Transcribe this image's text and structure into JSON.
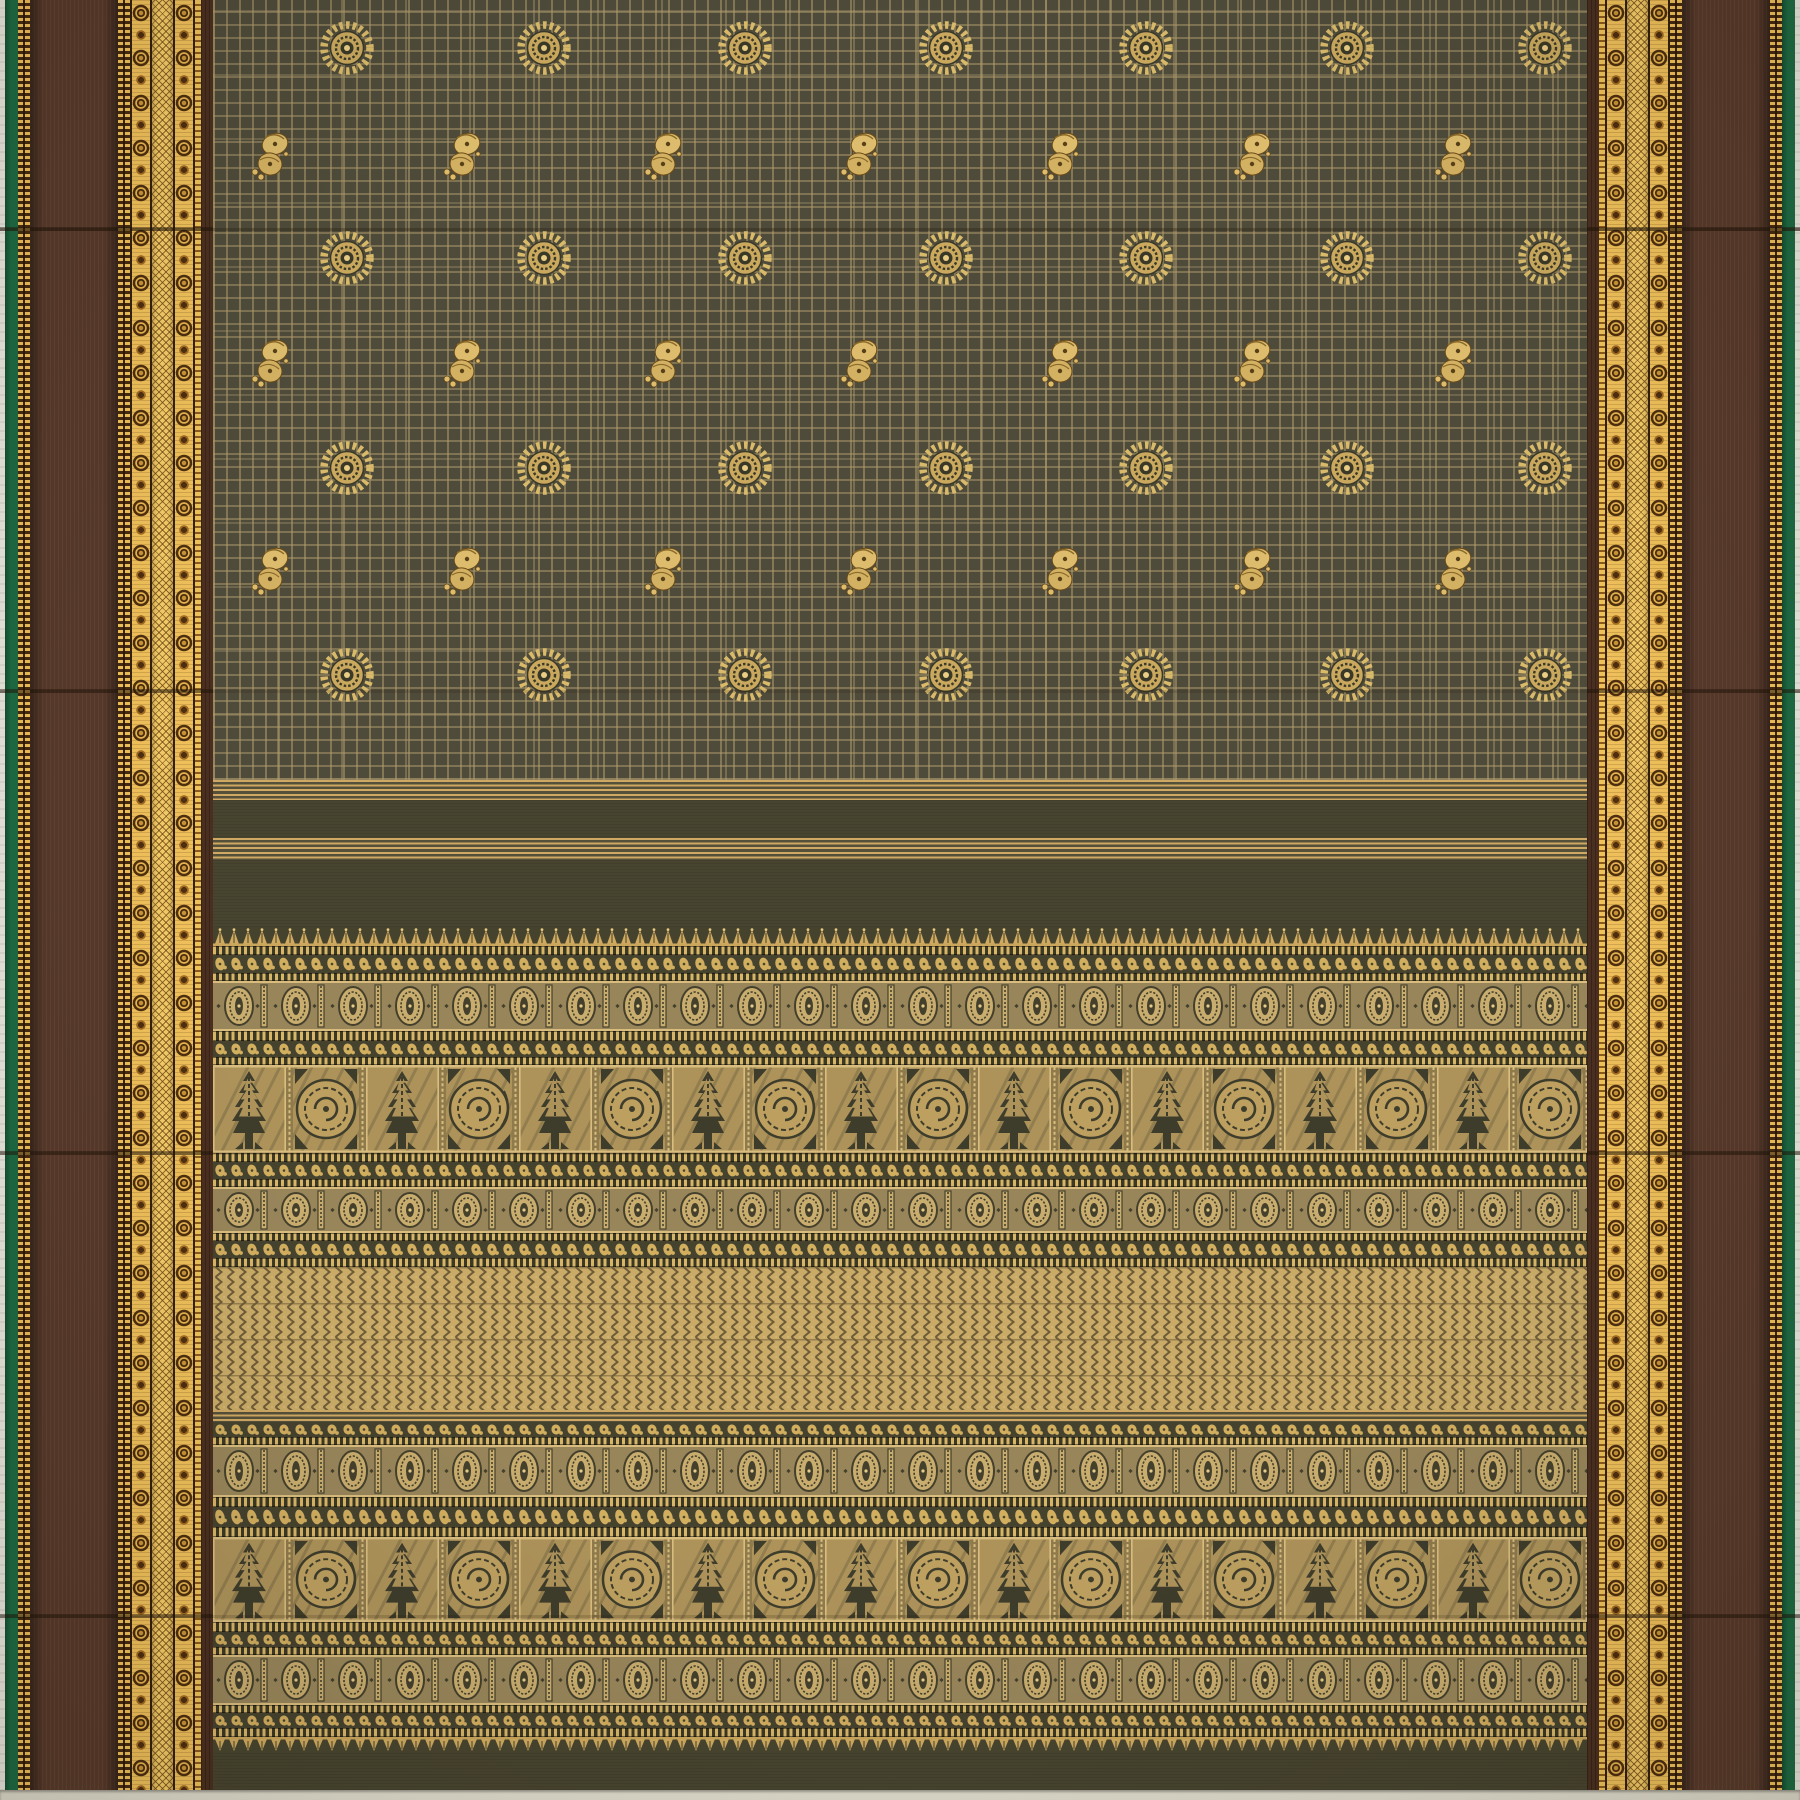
{
  "description": "Flat-lay photograph of a handloom saree: dark olive-grey body with fine gold checks and gold zari buttas (chakra discs and paisley mangoes), maroon-brown side borders with ornate gold zari bands on green selvedges, and a wide gold pallu of temple spires, medallion bands, tree-and-peacock motif rows and a gold herringbone field",
  "palette": {
    "selvage_white": "#eae7de",
    "selvage_bottom": "#dedacb",
    "green": "#1d6a43",
    "green_dark": "#124e31",
    "brown": "#57392a",
    "brown_inner": "#4a2f20",
    "gold_bright": "#efc05a",
    "gold_dark_motif": "#4d2e10",
    "mesh_gold": "#f4ca67",
    "body_olive": "#4e4b3a",
    "check_line": "#af9b6c",
    "butta_gold": "#d9ba6a",
    "butta_core_dark": "#3a3827",
    "plain_band": "#47442f",
    "stripe_gold": "#cfa963",
    "pallu_base_dark": "#45422e",
    "pallu_gold": "#d2ae5f",
    "medallion_bg": "#98855a",
    "medallion_gold": "#c9ad6e",
    "medallion_dark": "#44402c",
    "panel_gold": "#ad935a",
    "panel_dark": "#3e3c2b",
    "herringbone_gold": "#c9ab67",
    "herringbone_line": "#6e5b38",
    "crease": "rgba(32,20,9,0.45)"
  },
  "layout": {
    "width": 1800,
    "height": 1800,
    "border_width": 213,
    "body_left": 213,
    "body_width": 1374,
    "body_height": 780,
    "bottom_selvage_y": 1790
  },
  "left_border_strips": [
    {
      "type": "selvage",
      "w": 5
    },
    {
      "type": "green",
      "w": 13
    },
    {
      "type": "gold-dot",
      "w": 12
    },
    {
      "type": "brown",
      "w": 88
    },
    {
      "type": "gold-dot",
      "w": 12
    },
    {
      "type": "ring-band",
      "w": 22
    },
    {
      "type": "mesh",
      "w": 21
    },
    {
      "type": "ring-band",
      "w": 22
    },
    {
      "type": "gold-line",
      "w": 6
    },
    {
      "type": "brown-inner",
      "w": 12
    }
  ],
  "right_border_strips": [
    {
      "type": "brown-inner",
      "w": 12
    },
    {
      "type": "gold-line",
      "w": 6
    },
    {
      "type": "ring-band",
      "w": 22
    },
    {
      "type": "mesh",
      "w": 21
    },
    {
      "type": "ring-band",
      "w": 22
    },
    {
      "type": "gold-dot",
      "w": 12
    },
    {
      "type": "brown",
      "w": 88
    },
    {
      "type": "gold-dot",
      "w": 12
    },
    {
      "type": "green",
      "w": 13
    },
    {
      "type": "selvage",
      "w": 5
    }
  ],
  "body_motif_rows": [
    {
      "motif": "chakra",
      "y": 48,
      "x": [
        347,
        544,
        745,
        946,
        1146,
        1347,
        1545
      ]
    },
    {
      "motif": "paisley",
      "y": 155,
      "x": [
        271,
        463,
        664,
        860,
        1061,
        1253,
        1454
      ]
    },
    {
      "motif": "chakra",
      "y": 258,
      "x": [
        347,
        544,
        745,
        946,
        1146,
        1347,
        1545
      ]
    },
    {
      "motif": "paisley",
      "y": 362,
      "x": [
        271,
        463,
        664,
        860,
        1061,
        1253,
        1454
      ]
    },
    {
      "motif": "chakra",
      "y": 468,
      "x": [
        347,
        544,
        745,
        946,
        1146,
        1347,
        1545
      ]
    },
    {
      "motif": "paisley",
      "y": 570,
      "x": [
        271,
        463,
        664,
        860,
        1061,
        1253,
        1454
      ]
    },
    {
      "motif": "chakra",
      "y": 675,
      "x": [
        347,
        544,
        745,
        946,
        1146,
        1347,
        1545
      ]
    }
  ],
  "pallu_bands": [
    {
      "type": "stripe-gold",
      "y": 780,
      "h": 20
    },
    {
      "type": "plain",
      "y": 800,
      "h": 38
    },
    {
      "type": "stripe-gold",
      "y": 838,
      "h": 22
    },
    {
      "type": "plain",
      "y": 860,
      "h": 67
    },
    {
      "type": "spikes-up",
      "y": 927,
      "h": 19
    },
    {
      "type": "dot-line",
      "y": 946,
      "h": 9
    },
    {
      "type": "comma-row",
      "y": 955,
      "h": 18
    },
    {
      "type": "dot-line",
      "y": 973,
      "h": 8
    },
    {
      "type": "medallion-band",
      "y": 981,
      "h": 50
    },
    {
      "type": "dot-line",
      "y": 1031,
      "h": 10
    },
    {
      "type": "comma-row",
      "y": 1041,
      "h": 16
    },
    {
      "type": "dot-line",
      "y": 1057,
      "h": 8
    },
    {
      "type": "large-motif-row",
      "y": 1065,
      "h": 88
    },
    {
      "type": "dot-line",
      "y": 1153,
      "h": 9
    },
    {
      "type": "comma-row",
      "y": 1162,
      "h": 17
    },
    {
      "type": "dot-line",
      "y": 1179,
      "h": 8
    },
    {
      "type": "medallion-band",
      "y": 1187,
      "h": 46
    },
    {
      "type": "dot-line",
      "y": 1233,
      "h": 8
    },
    {
      "type": "comma-row",
      "y": 1241,
      "h": 17
    },
    {
      "type": "dot-line",
      "y": 1258,
      "h": 9
    },
    {
      "type": "herringbone",
      "y": 1267,
      "h": 143
    },
    {
      "type": "stripe-gold",
      "y": 1410,
      "h": 12
    },
    {
      "type": "comma-row",
      "y": 1422,
      "h": 15
    },
    {
      "type": "dot-line",
      "y": 1437,
      "h": 8
    },
    {
      "type": "medallion-band",
      "y": 1445,
      "h": 52
    },
    {
      "type": "dot-line",
      "y": 1497,
      "h": 10
    },
    {
      "type": "comma-row",
      "y": 1507,
      "h": 20
    },
    {
      "type": "dot-line",
      "y": 1527,
      "h": 10
    },
    {
      "type": "large-motif-row",
      "y": 1537,
      "h": 85
    },
    {
      "type": "dot-line",
      "y": 1622,
      "h": 10
    },
    {
      "type": "comma-row",
      "y": 1632,
      "h": 15
    },
    {
      "type": "dot-line",
      "y": 1647,
      "h": 8
    },
    {
      "type": "medallion-band",
      "y": 1655,
      "h": 50
    },
    {
      "type": "dot-line",
      "y": 1705,
      "h": 8
    },
    {
      "type": "comma-row",
      "y": 1713,
      "h": 15
    },
    {
      "type": "dot-line",
      "y": 1728,
      "h": 9
    },
    {
      "type": "spikes-down",
      "y": 1737,
      "h": 16
    },
    {
      "type": "plain",
      "y": 1753,
      "h": 37
    }
  ],
  "creases_y": [
    228,
    690,
    1152,
    1615
  ]
}
